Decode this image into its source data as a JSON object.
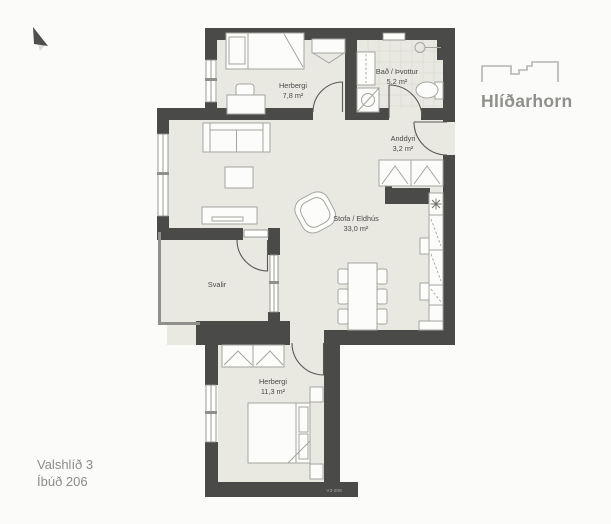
{
  "logo": {
    "brand": "Hlíðarhorn"
  },
  "address": {
    "line1": "Valshlíð 3",
    "line2": "Íbúð 206"
  },
  "plan": {
    "drawing_code": "V3-206",
    "rooms": [
      {
        "id": "bedroom-1",
        "name": "Herbergi",
        "area": "7,8 m²"
      },
      {
        "id": "bathroom",
        "name": "Bað / Þvottur",
        "area": "5,2 m²"
      },
      {
        "id": "entry",
        "name": "Anddyri",
        "area": "3,2 m²"
      },
      {
        "id": "living-kitchen",
        "name": "Stofa / Eldhús",
        "area": "33,0 m²"
      },
      {
        "id": "balcony",
        "name": "Svalir",
        "area": ""
      },
      {
        "id": "bedroom-2",
        "name": "Herbergi",
        "area": "11,3 m²"
      }
    ],
    "colors": {
      "wall": "#4a4a48",
      "floor": "#e9e8e1",
      "furniture_line": "#a5a5a0",
      "background": "#fbfbf9",
      "logo_gray": "#8f8f8c"
    }
  }
}
